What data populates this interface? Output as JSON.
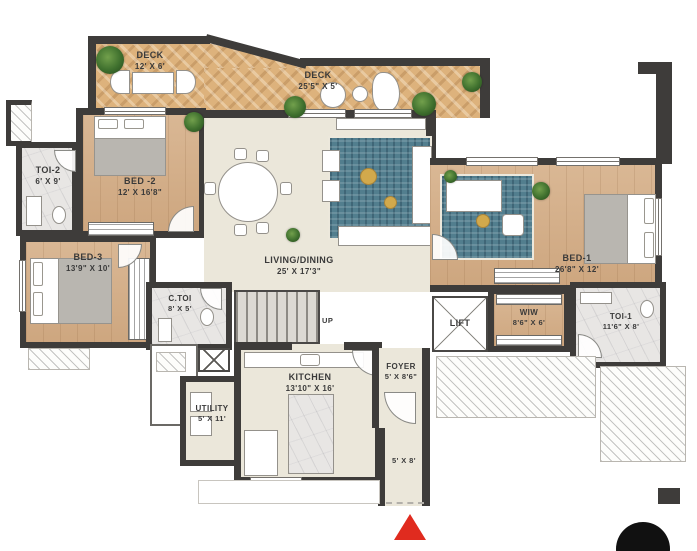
{
  "title": "Apartment floor plan",
  "rooms": {
    "deck1": {
      "name": "DECK",
      "dims": "12' X 6'"
    },
    "deck2": {
      "name": "DECK",
      "dims": "25'5\" X 5'"
    },
    "toi2": {
      "name": "TOI-2",
      "dims": "6' X 9'"
    },
    "bed2": {
      "name": "BED -2",
      "dims": "12' X 16'8\""
    },
    "bed3": {
      "name": "BED-3",
      "dims": "13'9\" X 10'"
    },
    "living": {
      "name": "LIVING/DINING",
      "dims": "25' X 17'3\""
    },
    "bed1": {
      "name": "BED-1",
      "dims": "26'8\" X 12'"
    },
    "ctoi": {
      "name": "C.TOI",
      "dims": "8' X 5'"
    },
    "lift": {
      "name": "LIFT"
    },
    "wiw": {
      "name": "WIW",
      "dims": "8'6\" X 6'"
    },
    "toi1": {
      "name": "TOI-1",
      "dims": "11'6\" X 8'"
    },
    "kitchen": {
      "name": "KITCHEN",
      "dims": "13'10\" X 16'"
    },
    "utility": {
      "name": "UTILITY",
      "dims": "5' X 11'"
    },
    "foyer": {
      "name": "FOYER",
      "dims": "5' X 8'6\""
    },
    "passage": {
      "dims": "5' X 8'"
    }
  },
  "stairs": {
    "label": "UP"
  },
  "markers": {
    "entrance_marker": "red-triangle-up",
    "page_marker": "black-circle"
  },
  "colors": {
    "wall": "#3e3c3a",
    "wood_floor": "#d5af88",
    "deck_floor": "#ddb27c",
    "neutral_floor": "#ebe7da",
    "marble_floor": "#e8e6e4",
    "rug": "#527e8e",
    "plant": "#3f702e",
    "accent_red": "#e02b1f",
    "marker_black": "#111111"
  }
}
